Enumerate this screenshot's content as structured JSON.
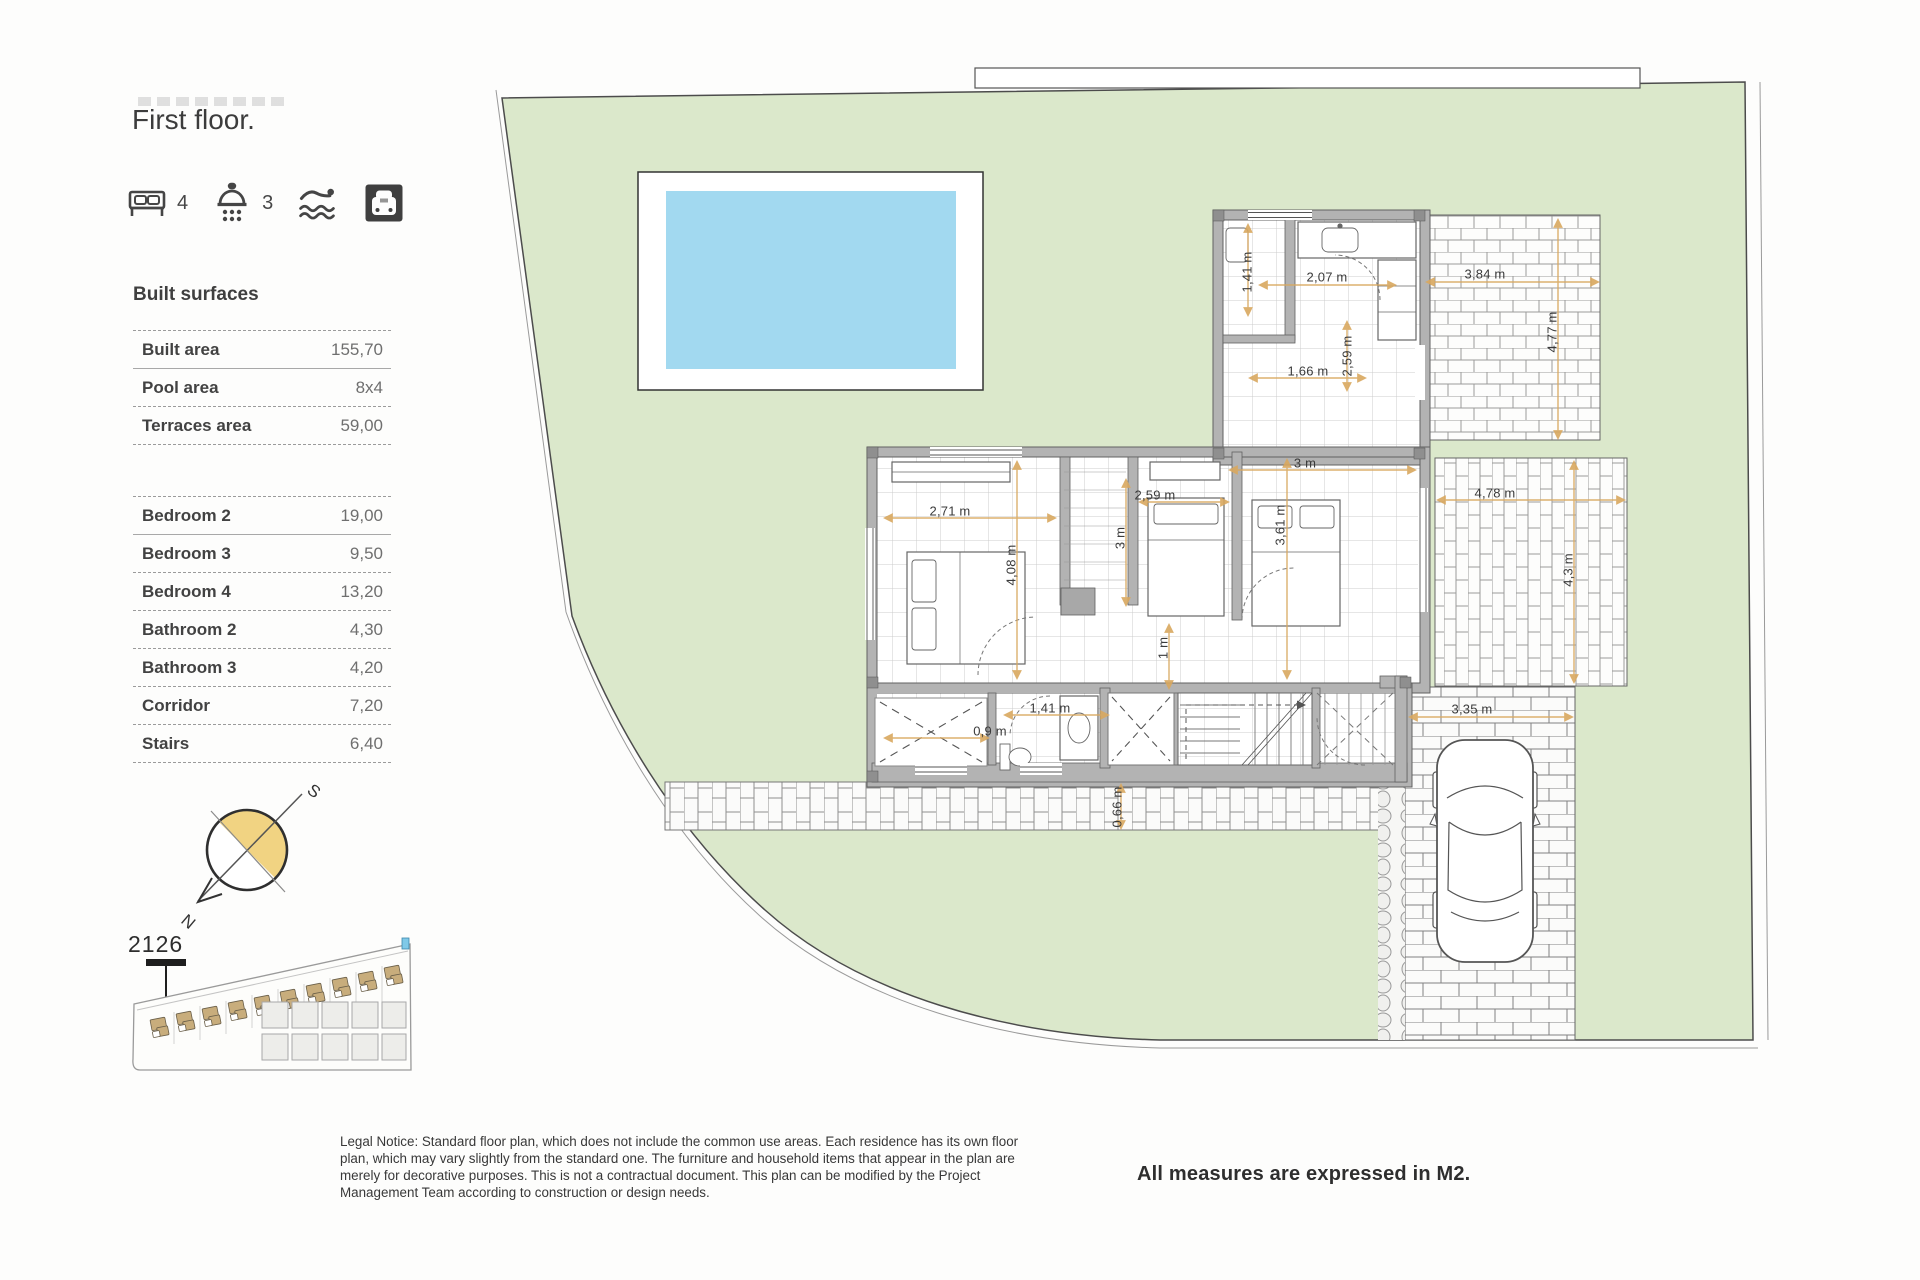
{
  "page": {
    "title": "First floor.",
    "legal_notice": "Legal Notice: Standard floor plan, which does not include the common use areas. Each residence has its own floor plan, which may vary slightly from the standard one. The furniture and household items that appear in the plan are merely for decorative purposes. This is not a contractual document. This plan can be modified by the Project Management Team according to construction or design needs.",
    "footer_note": "All measures are expressed in M2."
  },
  "amenities": {
    "bedrooms": "4",
    "bathrooms": "3",
    "icons": [
      "bed-icon",
      "shower-icon",
      "pool-icon",
      "garage-icon"
    ]
  },
  "built_surfaces": {
    "heading": "Built surfaces",
    "rows": [
      {
        "label": "Built area",
        "value": "155,70"
      },
      {
        "label": "Pool area",
        "value": "8x4"
      },
      {
        "label": "Terraces area",
        "value": "59,00"
      }
    ]
  },
  "rooms": {
    "rows": [
      {
        "label": "Bedroom 2",
        "value": "19,00"
      },
      {
        "label": "Bedroom 3",
        "value": "9,50"
      },
      {
        "label": "Bedroom 4",
        "value": "13,20"
      },
      {
        "label": "Bathroom 2",
        "value": "4,30"
      },
      {
        "label": "Bathroom 3",
        "value": "4,20"
      },
      {
        "label": "Corridor",
        "value": "7,20"
      },
      {
        "label": "Stairs",
        "value": "6,40"
      }
    ]
  },
  "compass": {
    "north": "N",
    "south": "S"
  },
  "site": {
    "unit_number": "2126"
  },
  "plan": {
    "dimensions": [
      {
        "text": "1,41 m"
      },
      {
        "text": "2,07 m"
      },
      {
        "text": "1,66 m"
      },
      {
        "text": "2,59 m"
      },
      {
        "text": "3,84 m"
      },
      {
        "text": "4,77 m"
      },
      {
        "text": "3 m"
      },
      {
        "text": "2,71 m"
      },
      {
        "text": "4,08 m"
      },
      {
        "text": "2,59 m"
      },
      {
        "text": "3 m"
      },
      {
        "text": "3,61 m"
      },
      {
        "text": "4,78 m"
      },
      {
        "text": "4,3 m"
      },
      {
        "text": "1 m"
      },
      {
        "text": "1,41 m"
      },
      {
        "text": "0,9 m"
      },
      {
        "text": "0,66 m"
      },
      {
        "text": "3,35 m"
      }
    ]
  },
  "colors": {
    "lawn": "#dbe8cb",
    "pool_water": "#a2d9f0",
    "compass_yellow": "#f1d382",
    "villa_tan": "#c8ad7c",
    "wall_grey": "#b3b3b3",
    "dimension_arrow": "#d9a85f"
  }
}
